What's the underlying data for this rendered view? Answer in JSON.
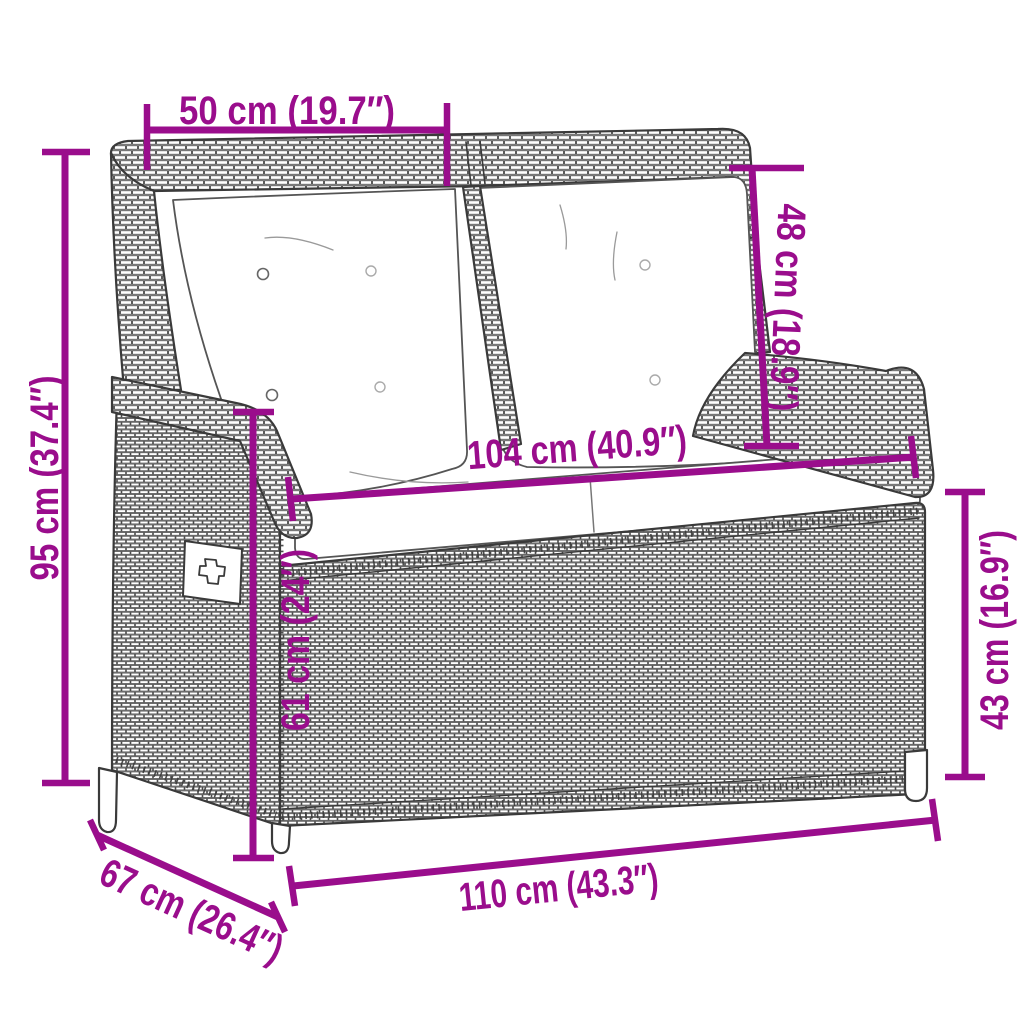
{
  "diagram": {
    "type": "product-dimension-diagram",
    "subject": "poly-rattan reclining garden bench with cushions and storage box",
    "colors": {
      "dimension_annotation": "#9A0D8C",
      "line_art": "#3A3A3A",
      "background": "#FFFFFF",
      "cushion": "#FFFFFF"
    },
    "dimensions": [
      {
        "name": "backrest-section-width",
        "label": "50 cm (19.7″)"
      },
      {
        "name": "total-height",
        "label": "95 cm (37.4″)"
      },
      {
        "name": "backrest-height",
        "label": "48 cm (18.9″)"
      },
      {
        "name": "seat-width",
        "label": "104 cm (40.9″)"
      },
      {
        "name": "seat-front-height",
        "label": "61 cm (24″)"
      },
      {
        "name": "box-side-height",
        "label": "43 cm (16.9″)"
      },
      {
        "name": "total-width",
        "label": "110 cm (43.3″)"
      },
      {
        "name": "total-depth",
        "label": "67 cm (26.4″)"
      }
    ]
  }
}
